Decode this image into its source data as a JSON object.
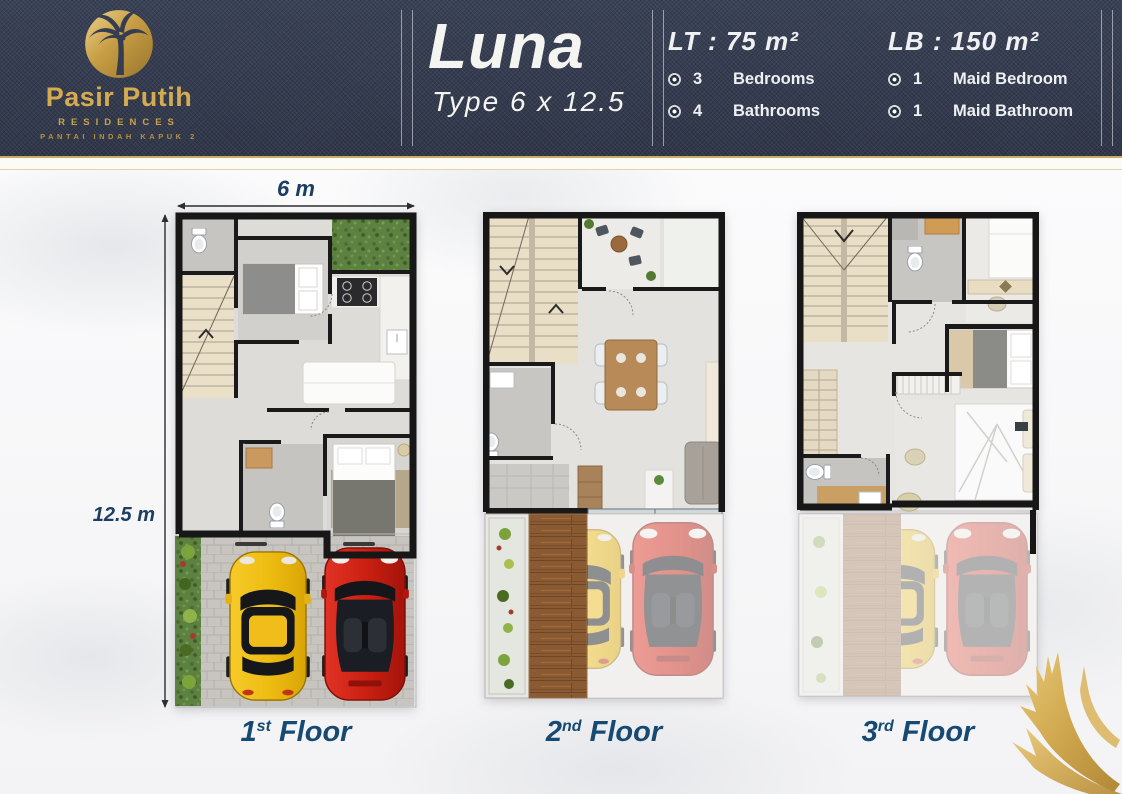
{
  "brand": {
    "name": "Pasir Putih",
    "residences": "RESIDENCES",
    "location": "PANTAI INDAH KAPUK 2",
    "logo_icon": "palm-tree-icon"
  },
  "unit": {
    "name": "Luna",
    "type": "Type 6 x 12.5"
  },
  "specs": {
    "land": "LT : 75 m²",
    "building": "LB : 150 m²",
    "bullet_icon": "radio-bullet-icon",
    "left": [
      {
        "count": "3",
        "label": "Bedrooms"
      },
      {
        "count": "4",
        "label": "Bathrooms"
      }
    ],
    "right": [
      {
        "count": "1",
        "label": "Maid Bedroom"
      },
      {
        "count": "1",
        "label": "Maid Bathroom"
      }
    ]
  },
  "plans": {
    "width_label": "6 m",
    "depth_label": "12.5 m",
    "floors": [
      {
        "num": "1",
        "sup": "st",
        "word": "Floor"
      },
      {
        "num": "2",
        "sup": "nd",
        "word": "Floor"
      },
      {
        "num": "3",
        "sup": "rd",
        "word": "Floor"
      }
    ]
  },
  "decor": {
    "corner_icon": "gold-palm-frond-icon"
  },
  "colors": {
    "header_navy": "#353D51",
    "gold": "#C9A24B",
    "floor_label_blue": "#17496F",
    "dimension_blue": "#1C3E63",
    "wall_black": "#1A1A1A",
    "car_yellow": "#F2C21E",
    "car_red": "#C9221A"
  }
}
